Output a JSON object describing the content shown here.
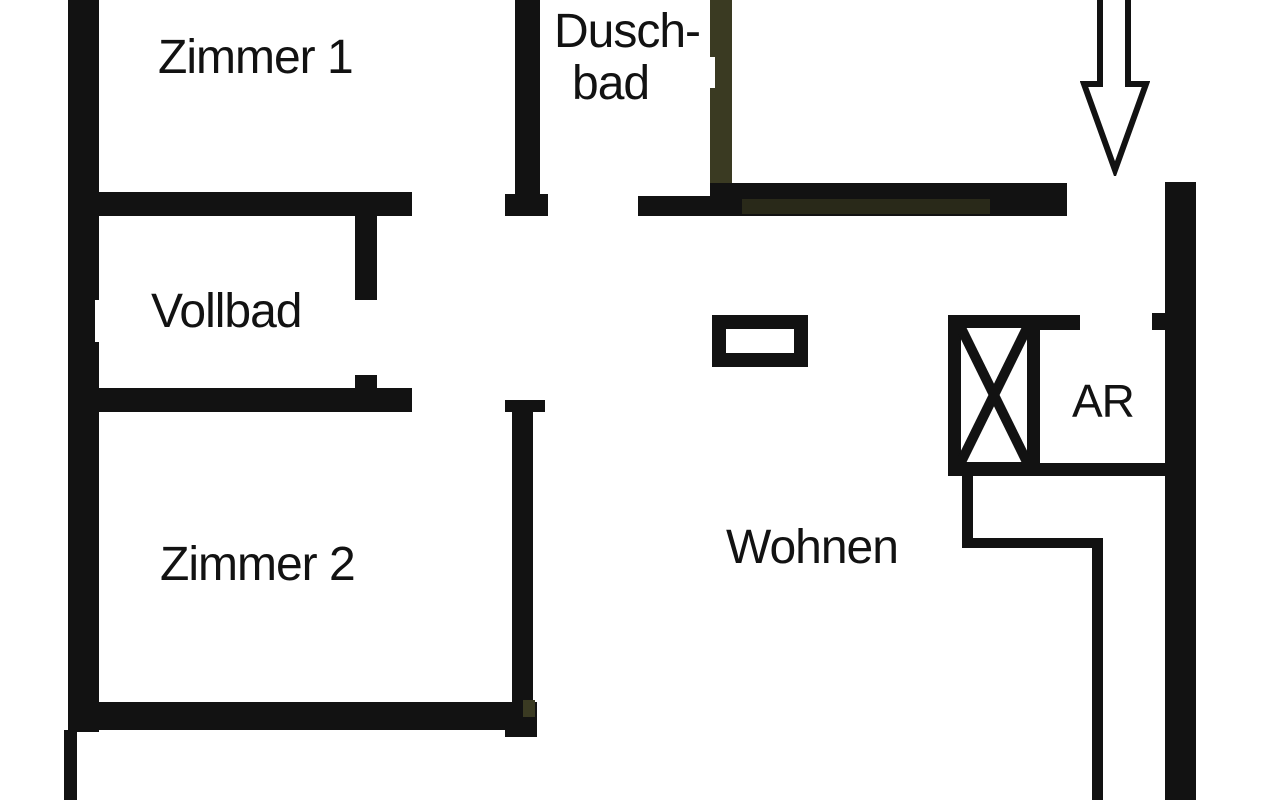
{
  "title": "Grundriss Wohnung (floor plan)",
  "colors": {
    "wall": "#121212",
    "olive": "#3a3a22",
    "olive_tint": "rgba(70,70,35,0.45)",
    "white": "#ffffff",
    "background": "#ffffff",
    "text": "#121212"
  },
  "rooms": {
    "zimmer1": {
      "label": "Zimmer 1"
    },
    "duschbad_line1": {
      "label": "Dusch-"
    },
    "duschbad_line2": {
      "label": "bad"
    },
    "vollbad": {
      "label": "Vollbad"
    },
    "zimmer2": {
      "label": "Zimmer 2"
    },
    "wohnen": {
      "label": "Wohnen"
    },
    "ar": {
      "label": "AR"
    }
  },
  "symbols": {
    "entrance_arrow": "down-arrow marking apartment entrance",
    "shaft_x": "crossed-box shaft/duct symbol next to AR",
    "pillar": "rectangular pillar outline in Wohnen"
  },
  "plan": {
    "width": 1280,
    "height": 800,
    "walls": [
      {
        "name": "left-outer-wall",
        "x": 68,
        "y": 0,
        "w": 31,
        "h": 732
      },
      {
        "name": "left-wall-window-notch",
        "x": 95,
        "y": 300,
        "w": 5,
        "h": 42,
        "c": "white"
      },
      {
        "name": "zimmer1-south-wall",
        "x": 68,
        "y": 192,
        "w": 344,
        "h": 24
      },
      {
        "name": "duschbad-west-wall",
        "x": 515,
        "y": 0,
        "w": 25,
        "h": 194
      },
      {
        "name": "zimmer1-door-jamb",
        "x": 505,
        "y": 194,
        "w": 43,
        "h": 22
      },
      {
        "name": "hall-band-thin",
        "x": 638,
        "y": 196,
        "w": 74,
        "h": 20
      },
      {
        "name": "entry-south-band",
        "x": 710,
        "y": 183,
        "w": 357,
        "h": 33
      },
      {
        "name": "entry-band-olive-tint",
        "x": 742,
        "y": 199,
        "w": 248,
        "h": 15,
        "c": "olive_tint"
      },
      {
        "name": "duschbad-east-wall",
        "x": 710,
        "y": 0,
        "w": 22,
        "h": 183,
        "c": "olive"
      },
      {
        "name": "duschbad-door-notch",
        "x": 710,
        "y": 57,
        "w": 5,
        "h": 31,
        "c": "white"
      },
      {
        "name": "right-outer-wall",
        "x": 1165,
        "y": 182,
        "w": 31,
        "h": 618
      },
      {
        "name": "ar-door-stub",
        "x": 1152,
        "y": 313,
        "w": 13,
        "h": 17
      },
      {
        "name": "ar-north-wall",
        "x": 1028,
        "y": 315,
        "w": 52,
        "h": 15
      },
      {
        "name": "ar-south-wall",
        "x": 948,
        "y": 463,
        "w": 248,
        "h": 13
      },
      {
        "name": "step-wall-vertical-1",
        "x": 962,
        "y": 476,
        "w": 11,
        "h": 72
      },
      {
        "name": "step-wall-horizontal",
        "x": 962,
        "y": 538,
        "w": 141,
        "h": 10
      },
      {
        "name": "step-wall-vertical-2",
        "x": 1092,
        "y": 548,
        "w": 11,
        "h": 252
      },
      {
        "name": "vollbad-east-wall",
        "x": 355,
        "y": 216,
        "w": 22,
        "h": 84
      },
      {
        "name": "vollbad-east-stub",
        "x": 355,
        "y": 375,
        "w": 22,
        "h": 15
      },
      {
        "name": "vollbad-south-wall",
        "x": 68,
        "y": 388,
        "w": 344,
        "h": 24
      },
      {
        "name": "zimmer2-door-jamb",
        "x": 505,
        "y": 400,
        "w": 40,
        "h": 12
      },
      {
        "name": "zimmer2-east-wall",
        "x": 512,
        "y": 400,
        "w": 21,
        "h": 302
      },
      {
        "name": "zimmer2-south-wall",
        "x": 68,
        "y": 702,
        "w": 469,
        "h": 28
      },
      {
        "name": "zimmer2-corner-foot",
        "x": 505,
        "y": 728,
        "w": 32,
        "h": 9
      },
      {
        "name": "corner-olive-patch",
        "x": 523,
        "y": 700,
        "w": 12,
        "h": 17,
        "c": "olive"
      },
      {
        "name": "outer-thin-wall-bottom-left",
        "x": 64,
        "y": 730,
        "w": 13,
        "h": 70
      }
    ]
  }
}
